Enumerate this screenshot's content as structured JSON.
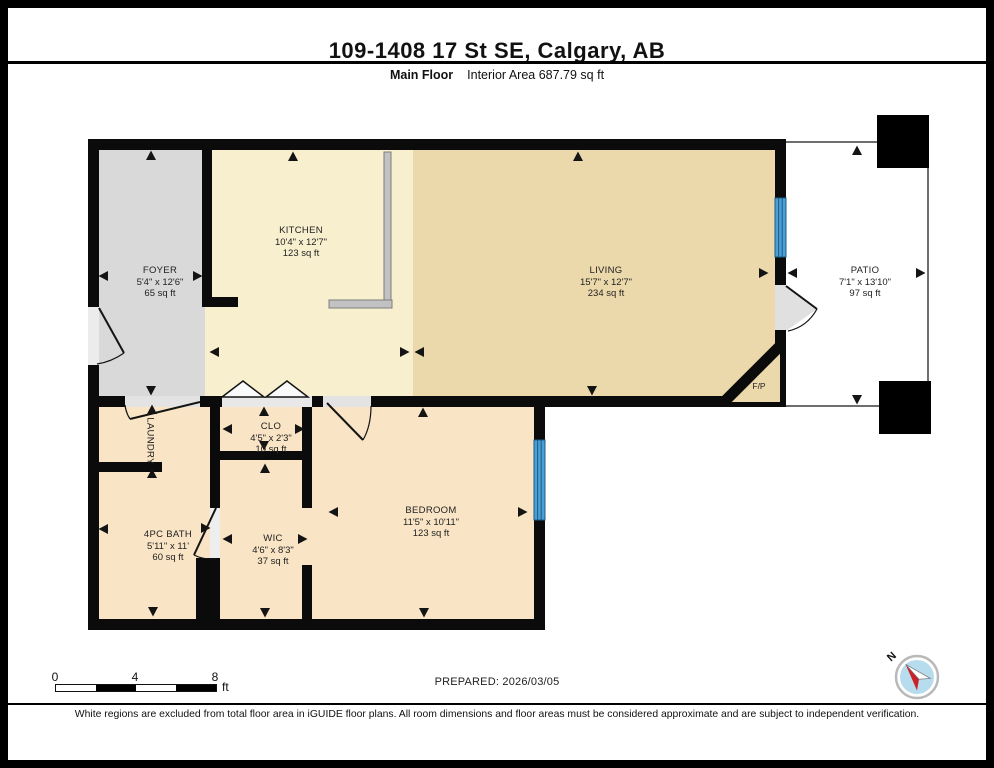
{
  "header": {
    "title": "109-1408 17 St SE, Calgary, AB",
    "floor_label": "Main Floor",
    "area_label": "Interior Area 687.79 sq ft"
  },
  "rooms": {
    "foyer": {
      "name": "FOYER",
      "dims": "5'4\" x 12'6\"",
      "area": "65 sq ft"
    },
    "kitchen": {
      "name": "KITCHEN",
      "dims": "10'4\" x 12'7\"",
      "area": "123 sq ft"
    },
    "living": {
      "name": "LIVING",
      "dims": "15'7\" x 12'7\"",
      "area": "234 sq ft"
    },
    "patio": {
      "name": "PATIO",
      "dims": "7'1\" x 13'10\"",
      "area": "97 sq ft"
    },
    "laundry": {
      "name": "LAUNDRY"
    },
    "clo": {
      "name": "CLO",
      "dims": "4'5\" x 2'3\"",
      "area": "10 sq ft"
    },
    "bath": {
      "name": "4PC BATH",
      "dims": "5'11\" x 11'",
      "area": "60 sq ft"
    },
    "wic": {
      "name": "WIC",
      "dims": "4'6\" x 8'3\"",
      "area": "37 sq ft"
    },
    "bedroom": {
      "name": "BEDROOM",
      "dims": "11'5\" x 10'11\"",
      "area": "123 sq ft"
    },
    "fireplace": {
      "name": "F/P"
    }
  },
  "scale_bar": {
    "tick0": "0",
    "tick4": "4",
    "tick8": "8",
    "unit": "ft"
  },
  "prepared_label": "PREPARED: 2026/03/05",
  "compass": {
    "north_label": "N"
  },
  "disclaimer": "White regions are excluded from total floor area in iGUIDE floor plans. All room dimensions and floor areas must be considered approximate and are subject to independent verification.",
  "colors": {
    "wall": "#0b0b0b",
    "foyer_fill": "#d9d9d9",
    "kitchen_fill": "#f8efce",
    "living_fill": "#ecd9ab",
    "bedroom_fill": "#f9e4c5",
    "window_blue": "#4a9fd3",
    "compass_blue": "#b7dcee",
    "compass_red": "#cc2127"
  }
}
